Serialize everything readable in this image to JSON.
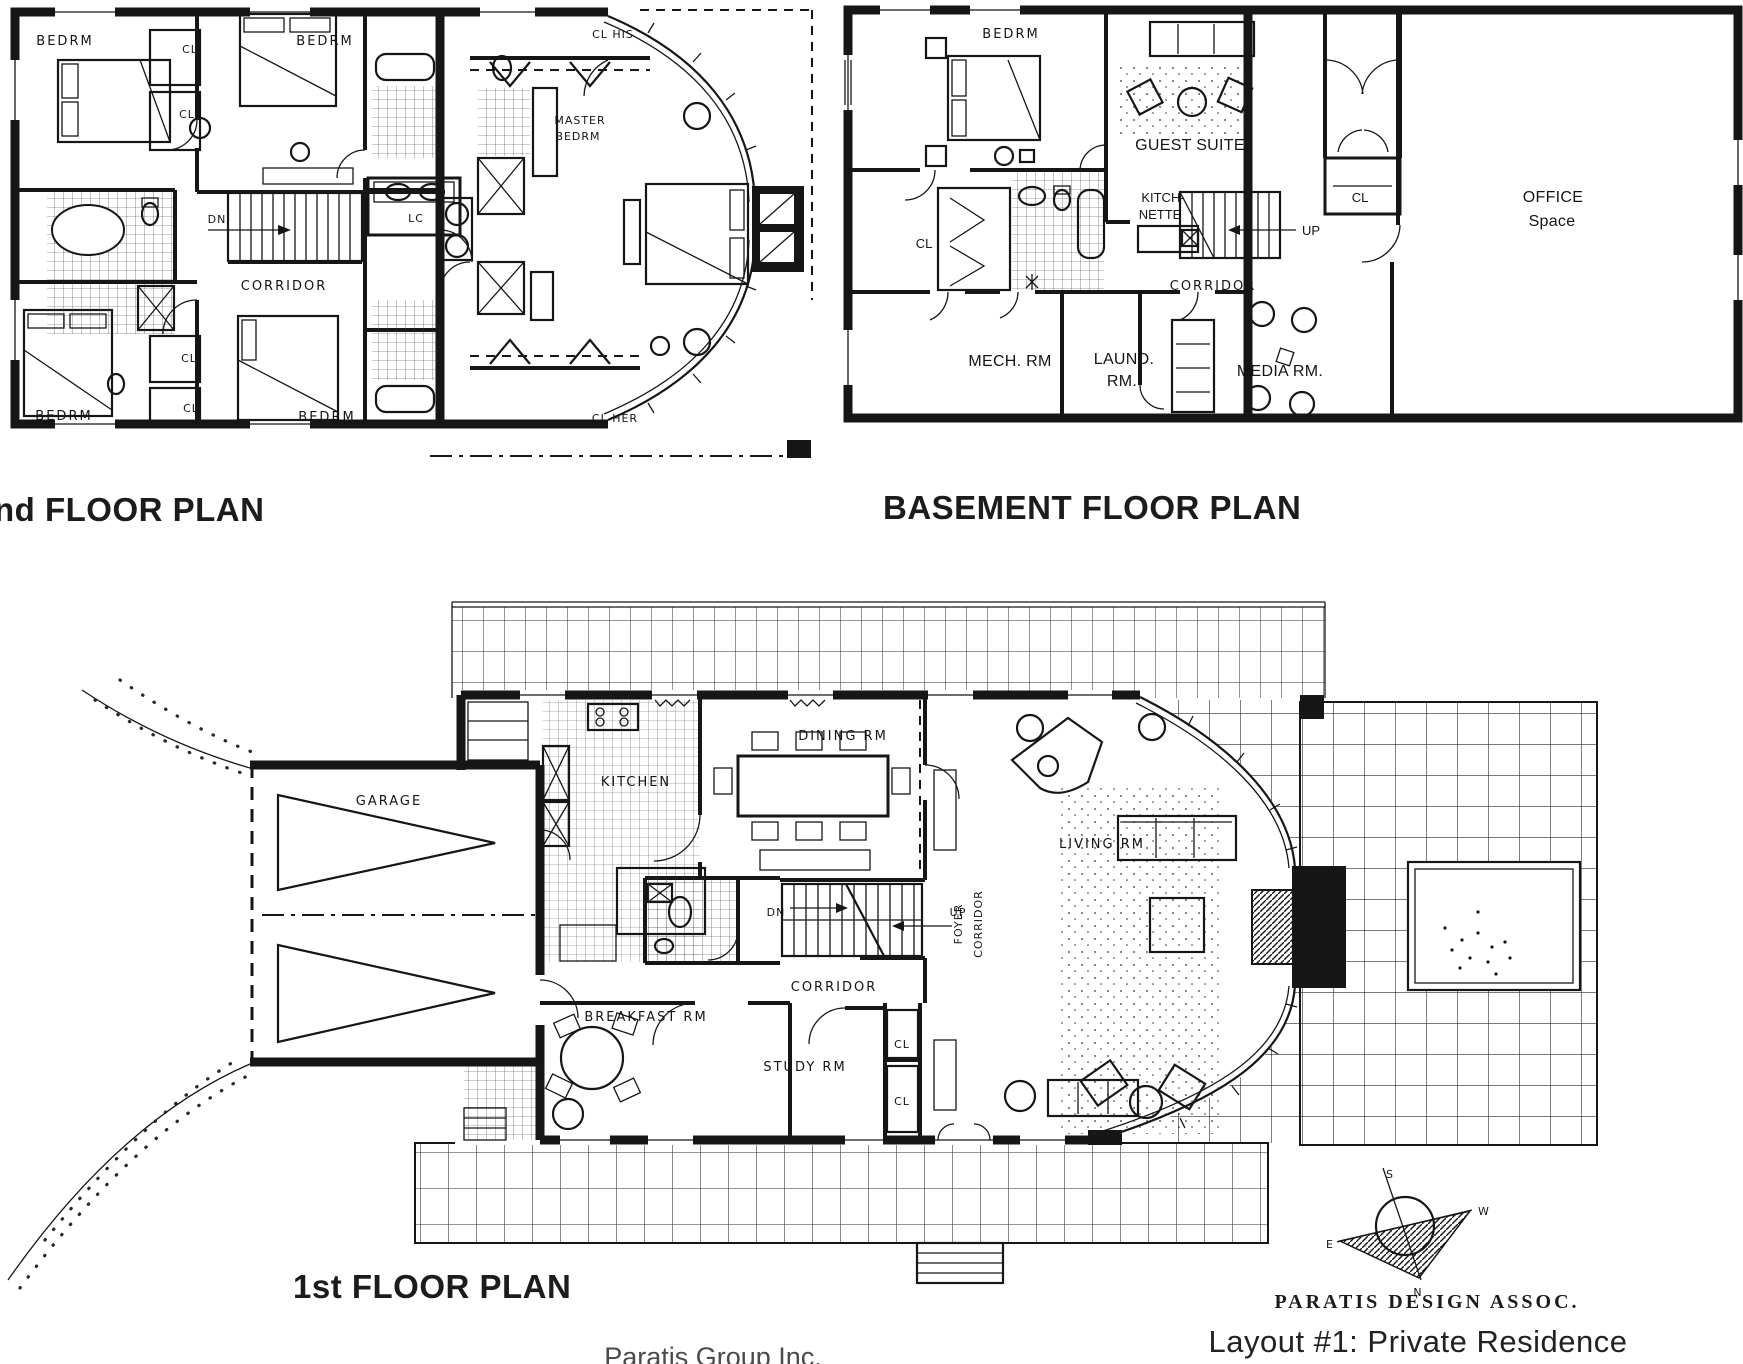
{
  "titles": {
    "second_floor": "nd FLOOR PLAN",
    "basement": "BASEMENT FLOOR PLAN",
    "first_floor": "1st FLOOR PLAN"
  },
  "second_floor": {
    "bedrm_nw": "BEDRM",
    "bedrm_ne": "BEDRM",
    "bedrm_sw": "BEDRM",
    "bedrm_se": "BEDRM",
    "cl_1": "CL",
    "cl_2": "CL",
    "cl_3": "CL",
    "cl_4": "CL",
    "lc": "LC",
    "cl_his": "CL HIS",
    "cl_her": "CL HER",
    "master_line1": "MASTER",
    "master_line2": "BEDRM",
    "corridor": "CORRIDOR",
    "dn": "DN"
  },
  "basement": {
    "bedrm": "BEDRM",
    "guest_suite": "GUEST SUITE",
    "kitchnette_line1": "KITCH-",
    "kitchnette_line2": "NETTE",
    "cl": "CL",
    "cl_entry": "CL",
    "up": "UP",
    "corridor": "CORRIDOR",
    "mech_rm": "MECH. RM",
    "laund_line1": "LAUND.",
    "laund_line2": "RM.",
    "media_rm": "MEDIA RM.",
    "office_line1": "OFFICE",
    "office_line2": "Space"
  },
  "first_floor": {
    "garage": "GARAGE",
    "kitchen": "KITCHEN",
    "dining_rm": "DINING RM",
    "breakfast_rm": "BREAKFAST RM",
    "study_rm": "STUDY RM",
    "corridor": "CORRIDOR",
    "foyer_line1": "FOYER",
    "foyer_line2": "CORRIDOR",
    "living_rm": "LIVING RM",
    "cl_upper": "CL",
    "cl_lower": "CL",
    "dn": "DN",
    "up": "UP"
  },
  "compass": {
    "n": "N",
    "s": "S",
    "e": "E",
    "w": "W"
  },
  "footer": {
    "design_firm": "PARATIS DESIGN ASSOC.",
    "layout_caption": "Layout #1: Private Residence",
    "company": "Paratis Group Inc."
  },
  "colors": {
    "ink": "#161616",
    "paper": "#ffffff",
    "gray_text": "#4a4a4a"
  }
}
